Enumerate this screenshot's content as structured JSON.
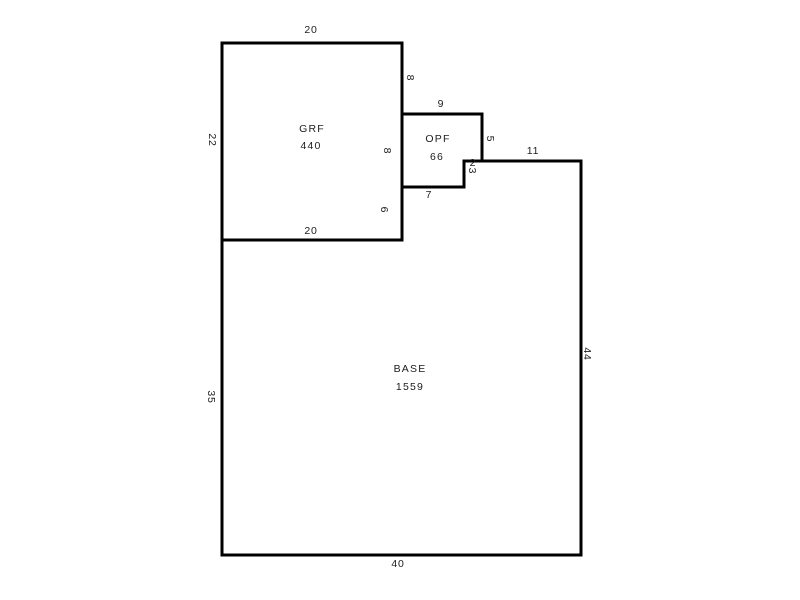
{
  "sketch": {
    "width": 800,
    "height": 600,
    "background": "#ffffff",
    "line_color": "#000000",
    "line_width": 3,
    "text_color": "#1c1c1c",
    "areas": [
      {
        "id": "grf",
        "label": "GRF",
        "area_value": "440",
        "points": [
          [
            222,
            43
          ],
          [
            402,
            43
          ],
          [
            402,
            240
          ],
          [
            222,
            240
          ]
        ],
        "label_x": 312,
        "label_y": 129,
        "value_x": 311,
        "value_y": 146
      },
      {
        "id": "opf",
        "label": "OPF",
        "area_value": "66",
        "points": [
          [
            402,
            114
          ],
          [
            482,
            114
          ],
          [
            482,
            161
          ],
          [
            464,
            161
          ],
          [
            464,
            187
          ],
          [
            402,
            187
          ]
        ],
        "label_x": 438,
        "label_y": 139,
        "value_x": 437,
        "value_y": 157
      },
      {
        "id": "base",
        "label": "BASE",
        "area_value": "1559",
        "points": [
          [
            222,
            240
          ],
          [
            402,
            240
          ],
          [
            402,
            187
          ],
          [
            464,
            187
          ],
          [
            464,
            161
          ],
          [
            581,
            161
          ],
          [
            581,
            555
          ],
          [
            222,
            555
          ]
        ],
        "label_x": 410,
        "label_y": 369,
        "value_x": 410,
        "value_y": 387
      }
    ],
    "dimensions": [
      {
        "text": "20",
        "x": 311,
        "y": 30,
        "rotated": false,
        "edge": "grf-top"
      },
      {
        "text": "22",
        "x": 212,
        "y": 140,
        "rotated": true,
        "edge": "grf-left"
      },
      {
        "text": "8",
        "x": 410,
        "y": 78,
        "rotated": true,
        "edge": "grf-right-upper"
      },
      {
        "text": "9",
        "x": 441,
        "y": 104,
        "rotated": false,
        "edge": "opf-top"
      },
      {
        "text": "8",
        "x": 387,
        "y": 151,
        "rotated": true,
        "edge": "grf-right-middle"
      },
      {
        "text": "5",
        "x": 490,
        "y": 139,
        "rotated": true,
        "edge": "opf-right"
      },
      {
        "text": "11",
        "x": 533,
        "y": 151,
        "rotated": false,
        "edge": "base-top-right"
      },
      {
        "text": "2",
        "x": 473,
        "y": 163,
        "rotated": false,
        "edge": "opf-notch-horizontal"
      },
      {
        "text": "3",
        "x": 472,
        "y": 171,
        "rotated": true,
        "edge": "opf-notch-vertical"
      },
      {
        "text": "7",
        "x": 429,
        "y": 195,
        "rotated": false,
        "edge": "opf-bottom"
      },
      {
        "text": "6",
        "x": 384,
        "y": 210,
        "rotated": true,
        "edge": "grf-right-lower"
      },
      {
        "text": "20",
        "x": 311,
        "y": 231,
        "rotated": false,
        "edge": "grf-bottom"
      },
      {
        "text": "35",
        "x": 211,
        "y": 397,
        "rotated": true,
        "edge": "base-left"
      },
      {
        "text": "44",
        "x": 587,
        "y": 354,
        "rotated": true,
        "edge": "base-right"
      },
      {
        "text": "40",
        "x": 398,
        "y": 564,
        "rotated": false,
        "edge": "base-bottom"
      }
    ]
  }
}
